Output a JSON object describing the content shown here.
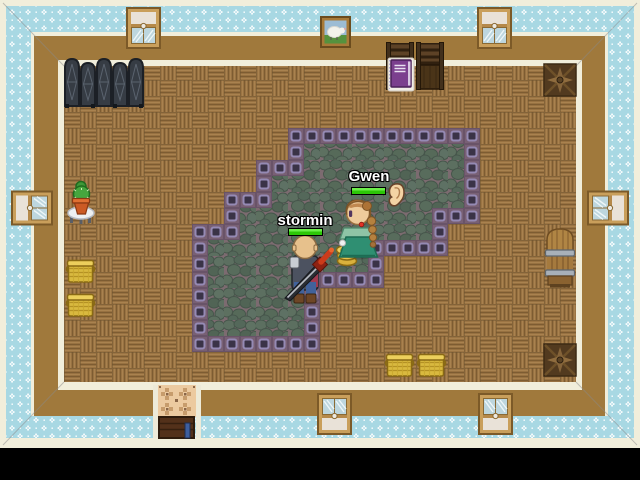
{
  "game": {
    "players": [
      {
        "name": "stormin",
        "hp_percent": 100
      },
      {
        "name": "Gwen",
        "hp_percent": 100
      }
    ],
    "emote": {
      "icon": "ear-icon"
    },
    "loot": {
      "gold_coin_stack_count": 3
    }
  },
  "palette": {
    "wallpaper_blue": "#a8d8e3",
    "wall_brown": "#a0793c",
    "trim_cream": "#f1eedb",
    "floor_wood": "#9b7443",
    "platform_border_purple": "#786074",
    "platform_square_dark": "#3a3347",
    "stone_floor_green": "#5a6c5e",
    "hp_bar_green": "#3fe01a",
    "void_black": "#000000"
  }
}
